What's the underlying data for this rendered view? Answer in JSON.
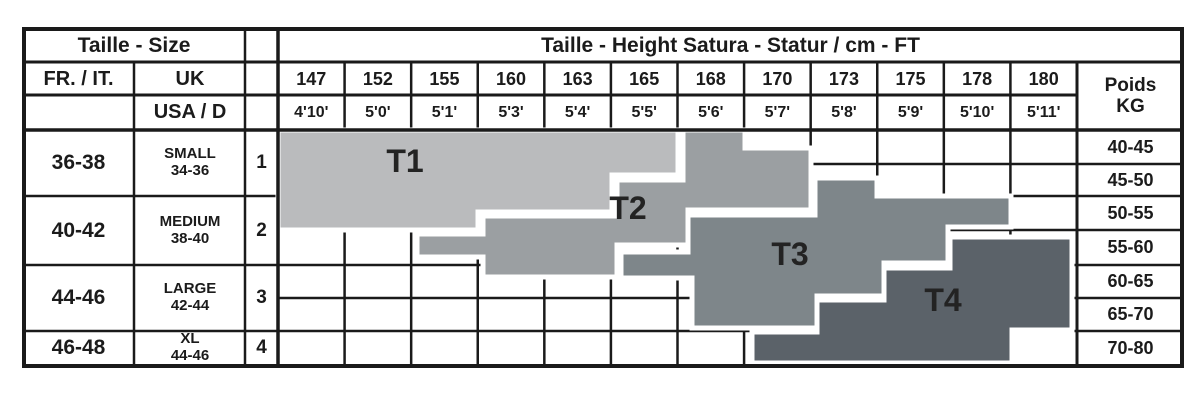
{
  "table": {
    "corner_header": "Taille - Size",
    "main_header": "Taille - Height Satura - Statur / cm - FT",
    "col_headers": {
      "fr_it": "FR. / IT.",
      "uk": "UK",
      "usa_d": "USA / D"
    },
    "weight_header": {
      "line1": "Poids",
      "line2": "KG"
    },
    "heights_cm": [
      "147",
      "152",
      "155",
      "160",
      "163",
      "165",
      "168",
      "170",
      "173",
      "175",
      "178",
      "180"
    ],
    "heights_ft": [
      "4'10'",
      "5'0'",
      "5'1'",
      "5'3'",
      "5'4'",
      "5'5'",
      "5'6'",
      "5'7'",
      "5'8'",
      "5'9'",
      "5'10'",
      "5'11'"
    ],
    "size_rows": [
      {
        "fr_it": "36-38",
        "uk_label": "SMALL",
        "uk_range": "34-36",
        "usa_d": "1"
      },
      {
        "fr_it": "40-42",
        "uk_label": "MEDIUM",
        "uk_range": "38-40",
        "usa_d": "2"
      },
      {
        "fr_it": "44-46",
        "uk_label": "LARGE",
        "uk_range": "42-44",
        "usa_d": "3"
      },
      {
        "fr_it": "46-48",
        "uk_label": "XL",
        "uk_range": "44-46",
        "usa_d": "4"
      }
    ],
    "weights_kg": [
      "40-45",
      "45-50",
      "50-55",
      "55-60",
      "60-65",
      "65-70",
      "70-80"
    ]
  },
  "chart_data": {
    "type": "heatmap",
    "title": "Taille - Height Satura - Statur / cm - FT",
    "x_categories_cm": [
      "147",
      "152",
      "155",
      "160",
      "163",
      "165",
      "168",
      "170",
      "173",
      "175",
      "178",
      "180"
    ],
    "x_categories_ft": [
      "4'10'",
      "5'0'",
      "5'1'",
      "5'3'",
      "5'4'",
      "5'5'",
      "5'6'",
      "5'7'",
      "5'8'",
      "5'9'",
      "5'10'",
      "5'11'"
    ],
    "y_categories_kg": [
      "40-45",
      "45-50",
      "50-55",
      "55-60",
      "60-65",
      "65-70",
      "70-80"
    ],
    "regions": [
      {
        "label": "T1",
        "color": "#babbbd",
        "label_x": 405,
        "label_y": 161,
        "height_range_cm": "147-165",
        "weight_range_kg": "40-55",
        "points": "278,130 678,130 678,175 612,175 612,212 478,212 478,230 278,230"
      },
      {
        "label": "T2",
        "color": "#9b9fa2",
        "label_x": 628,
        "label_y": 208,
        "height_range_cm": "152-170",
        "weight_range_kg": "40-60",
        "points": "683,130 745,130 745,148 811,148 811,210 688,210 688,245 617,245 617,277 483,277 483,257 417,257 417,234 483,234 483,216 617,216 617,180 683,180"
      },
      {
        "label": "T3",
        "color": "#7e868a",
        "label_x": 790,
        "label_y": 254,
        "height_range_cm": "160-175",
        "weight_range_kg": "50-70",
        "points": "815,178 877,178 877,196 1011,196 1011,227 948,227 948,263 884,263 884,296 817,296 817,328 692,328 692,278 621,278 621,252 688,252 688,215 815,215"
      },
      {
        "label": "T4",
        "color": "#5b6269",
        "label_x": 943,
        "label_y": 300,
        "height_range_cm": "168-180",
        "weight_range_kg": "55-80",
        "points": "950,237 1072,237 1072,330 1012,330 1012,363 752,363 752,332 817,332 817,300 884,300 884,268 950,268"
      }
    ]
  }
}
